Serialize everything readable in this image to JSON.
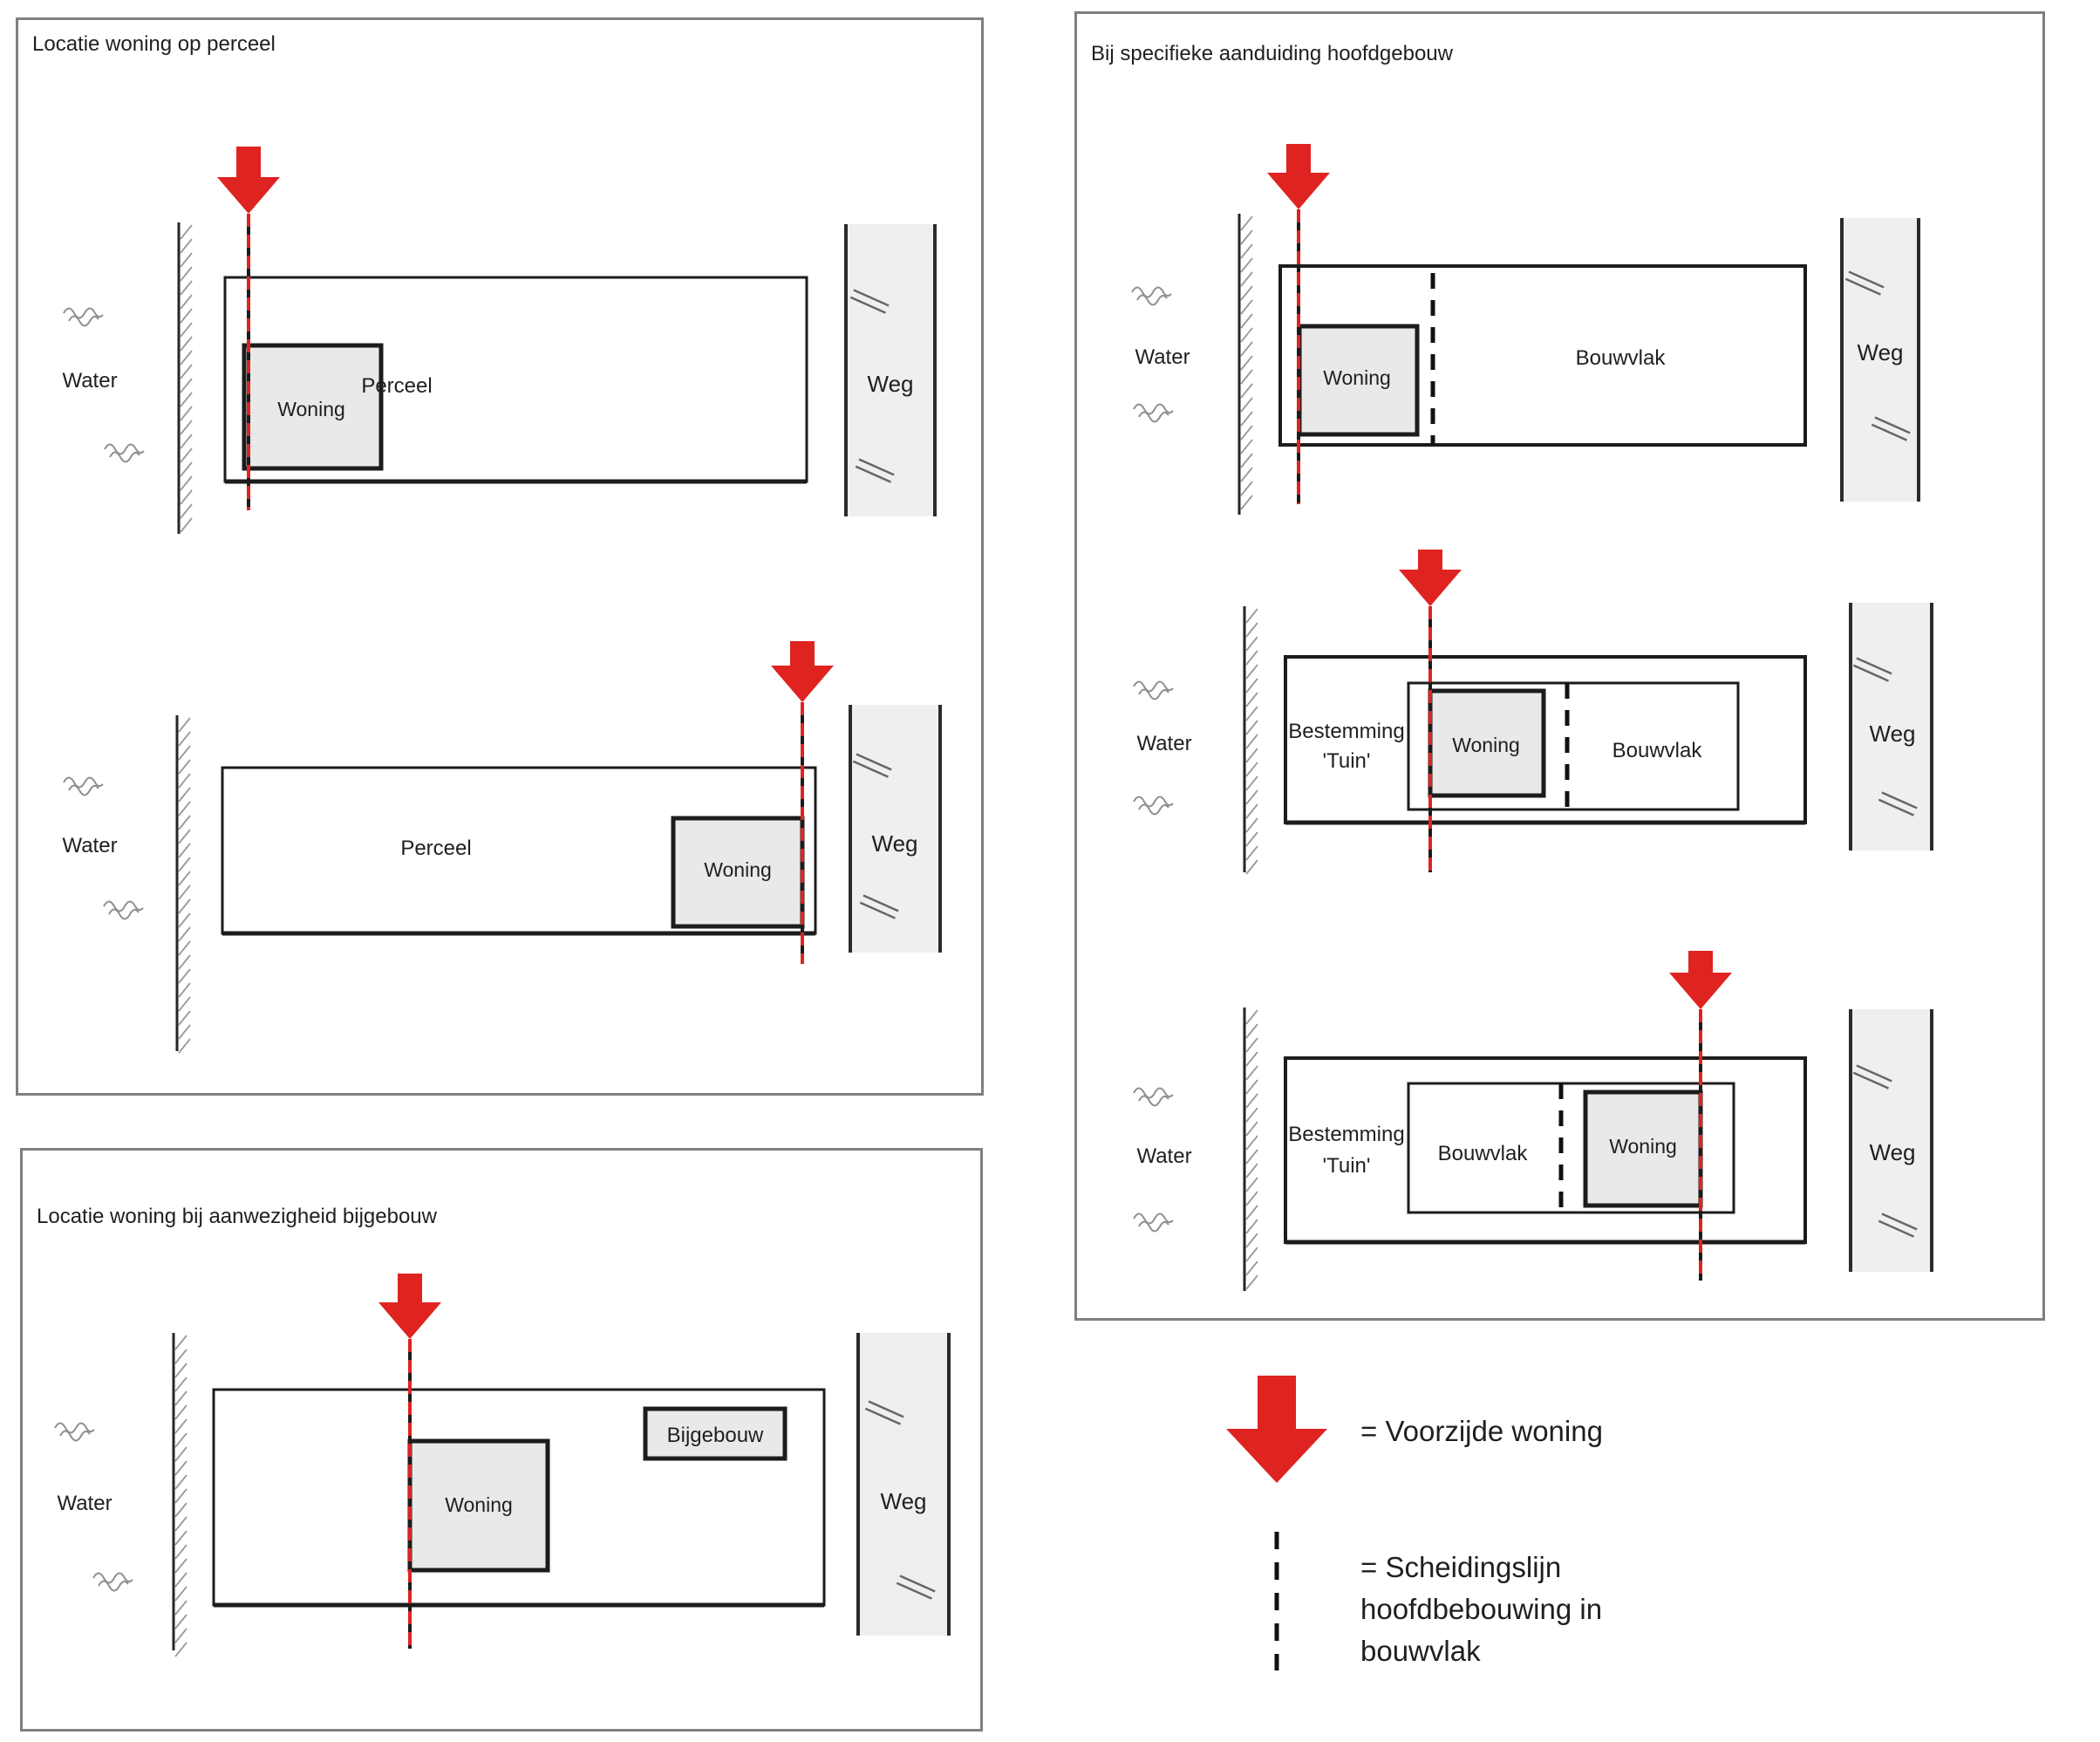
{
  "colors": {
    "red": "#df2321",
    "line": "#1c1c1c",
    "panel_border": "#7f7f7f",
    "road_fill": "#f0efed",
    "road_line": "#2b2b2b",
    "building_fill": "#e9e9e9",
    "text": "#1f1f1f",
    "hatch": "#9a9a9a",
    "wave": "#8f8f8f",
    "slash": "#666666"
  },
  "panels": [
    {
      "title": "Locatie woning op perceel"
    },
    {
      "title": "Locatie woning bij aanwezigheid bijgebouw"
    },
    {
      "title": "Bij specifieke aanduiding hoofdgebouw"
    }
  ],
  "labels": {
    "water": "Water",
    "weg": "Weg",
    "woning": "Woning",
    "perceel": "Perceel",
    "bouwvlak": "Bouwvlak",
    "bijgebouw": "Bijgebouw",
    "bestemming1": "Bestemming",
    "bestemming2": "'Tuin'"
  },
  "legend": {
    "voorzijde": "= Voorzijde woning",
    "scheidingslijn": [
      "= Scheidingslijn",
      "hoofdbebouwing in",
      "bouwvlak"
    ]
  }
}
